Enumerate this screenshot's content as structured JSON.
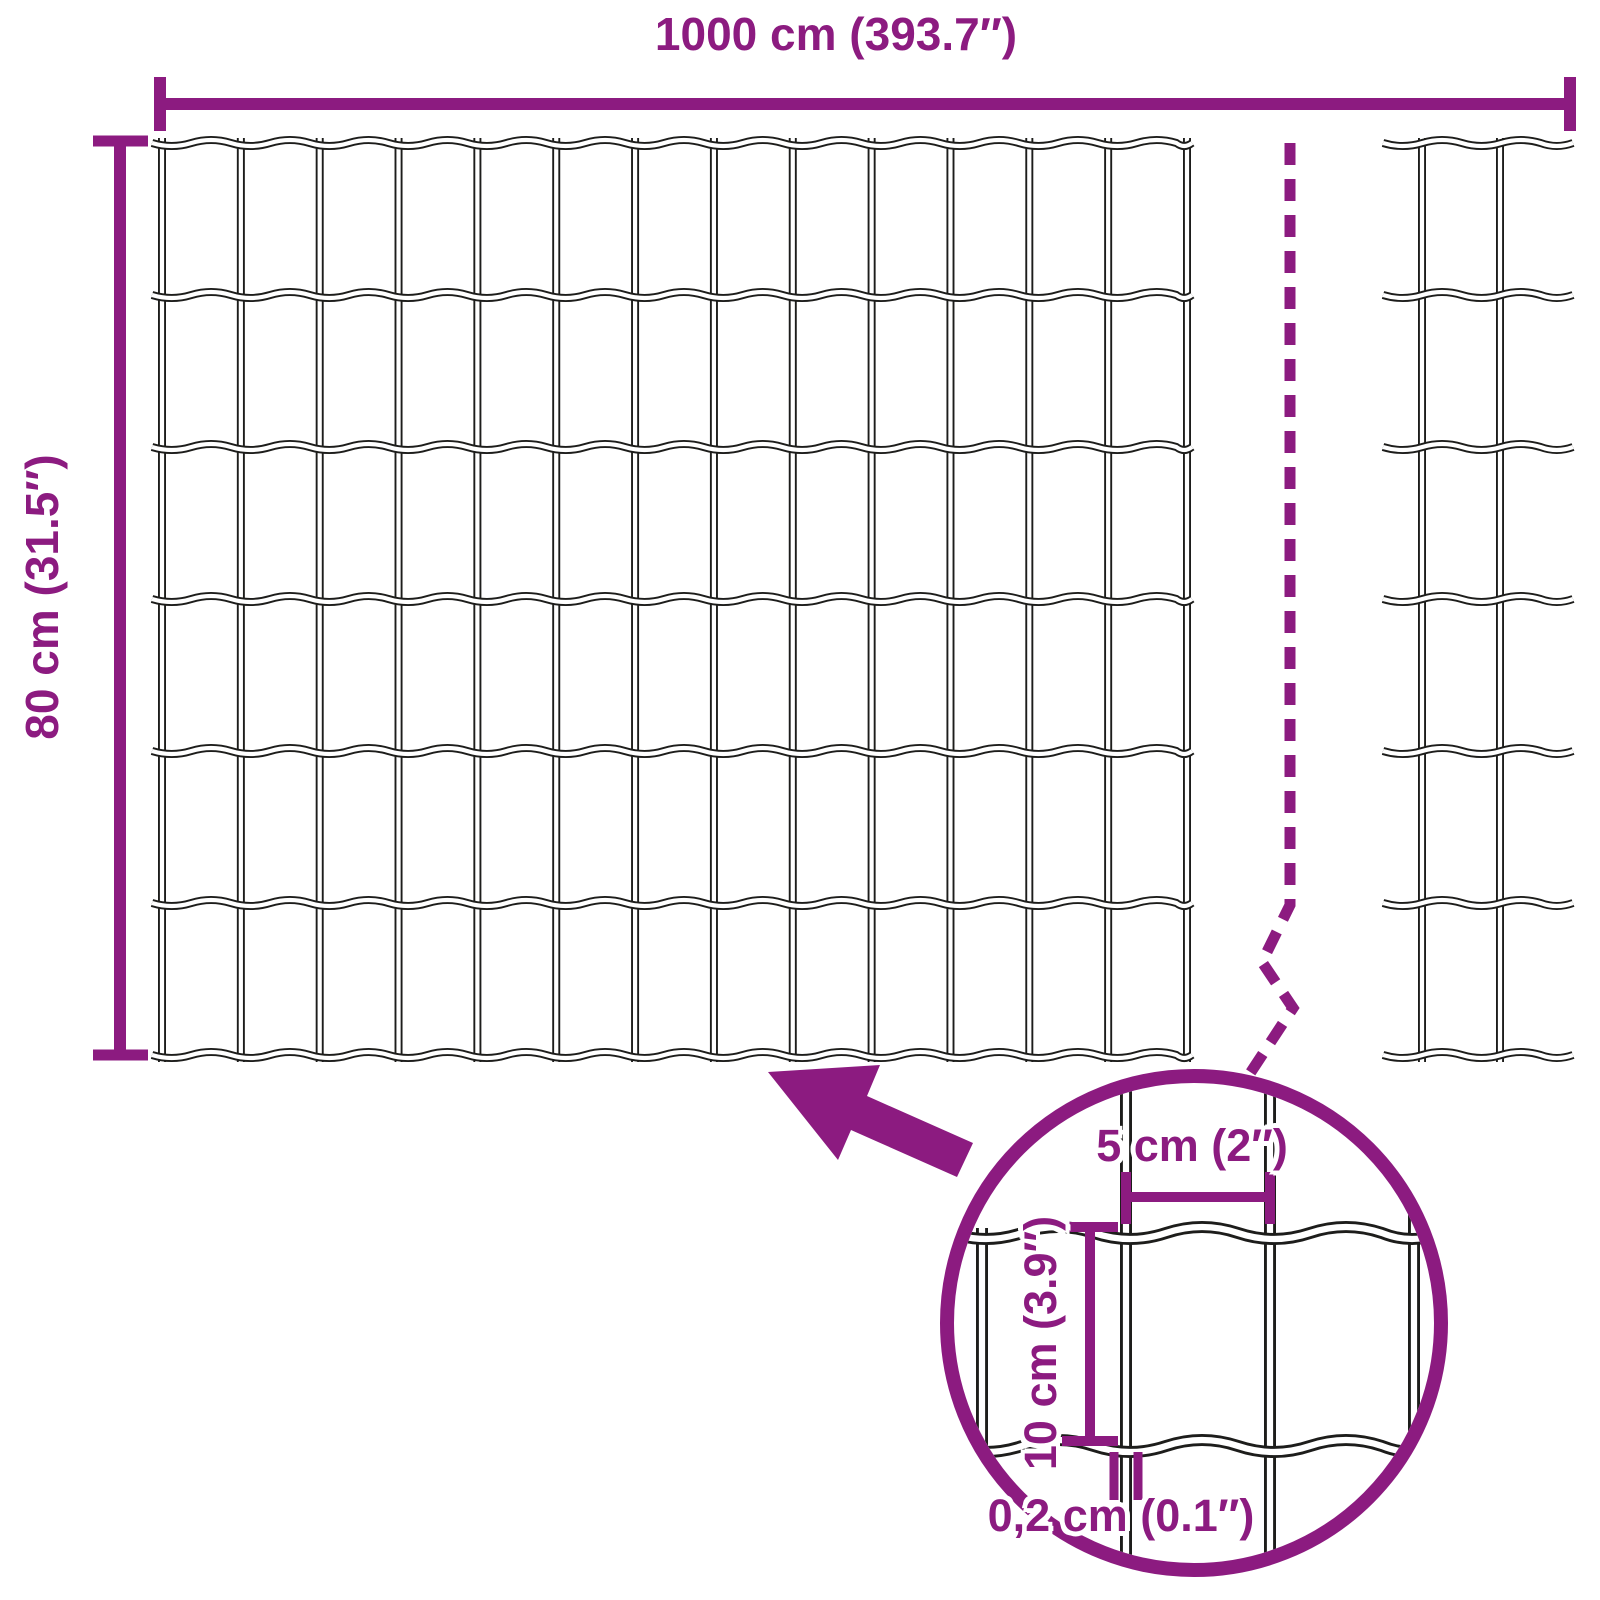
{
  "colors": {
    "accent": "#8C1B80",
    "wire": "#1d1d1b",
    "background": "#ffffff"
  },
  "labels": {
    "total_width": "1000 cm (393.7″)",
    "total_height": "80 cm (31.5″)",
    "mesh_width": "5 cm (2″)",
    "mesh_height": "10 cm (3.9″)",
    "wire_thickness": "0,2 cm (0.1″)"
  },
  "dimensions": {
    "total_width_cm": 1000,
    "total_width_in": 393.7,
    "total_height_cm": 80,
    "total_height_in": 31.5,
    "mesh_opening_width_cm": 5,
    "mesh_opening_width_in": 2,
    "mesh_opening_height_cm": 10,
    "mesh_opening_height_in": 3.9,
    "wire_thickness_cm": 0.2,
    "wire_thickness_in": 0.1
  },
  "mesh": {
    "main_panel": {
      "vertical_wires": 14,
      "horizontal_wires": 7
    },
    "right_panel": {
      "vertical_wires": 2,
      "horizontal_wires": 7
    },
    "magnified_detail": {
      "vertical_wires": 4,
      "horizontal_wires": 2
    }
  }
}
